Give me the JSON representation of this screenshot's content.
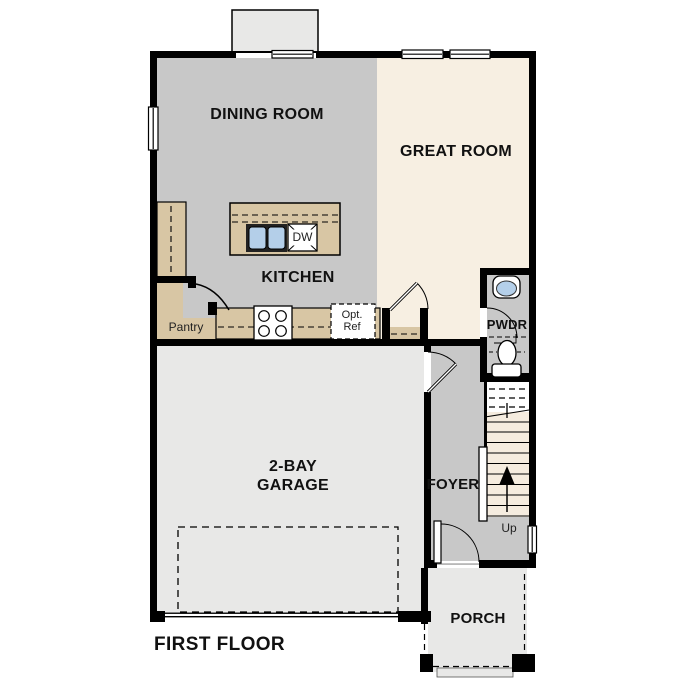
{
  "floor_plan": {
    "title": "FIRST FLOOR",
    "rooms": {
      "dining_room": "DINING ROOM",
      "great_room": "GREAT ROOM",
      "kitchen": "KITCHEN",
      "pantry": "Pantry",
      "powder_room": "PWDR",
      "foyer": "FOYER",
      "garage": "2-BAY GARAGE",
      "porch": "PORCH"
    },
    "annotations": {
      "dishwasher": "DW",
      "optional_refrigerator": "Opt. Ref",
      "stair_direction": "Up"
    },
    "colors": {
      "wall": "#000000",
      "interior_floor": "#c8c8c8",
      "great_room_floor": "#f7efe2",
      "stair_tread": "#f5ecdf",
      "garage_floor": "#e8e8e7",
      "counter": "#d8c6a4",
      "sink_blue": "#b4cfe9"
    }
  }
}
